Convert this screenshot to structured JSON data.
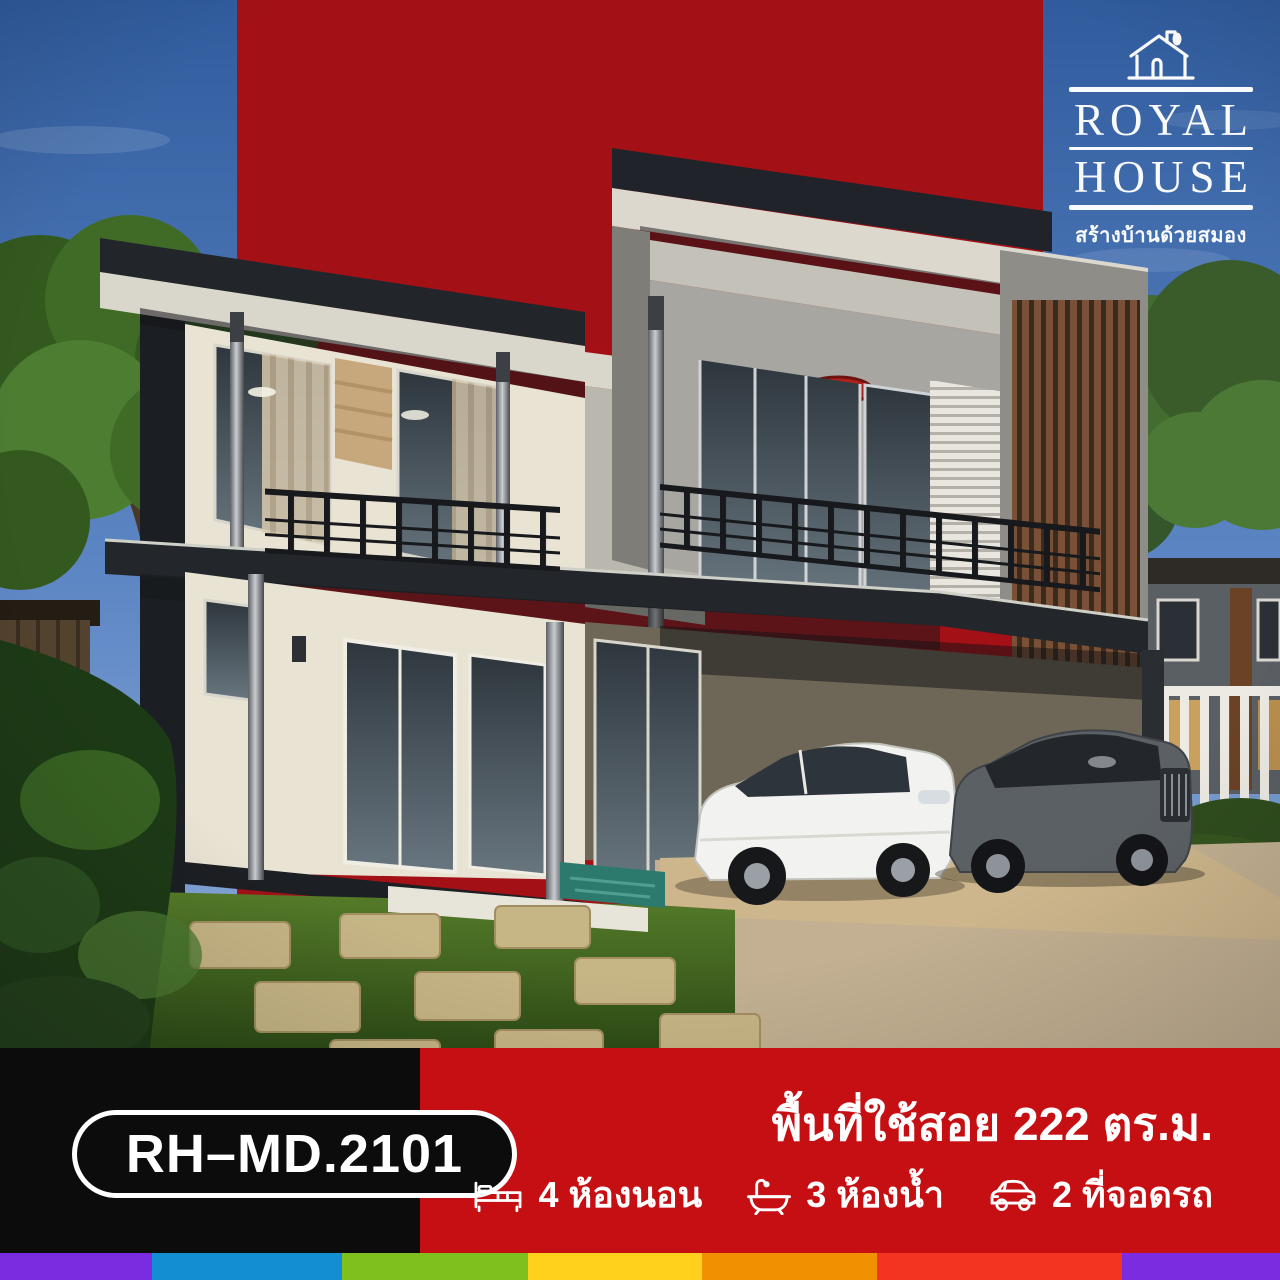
{
  "brand": {
    "name_line1": "ROYAL",
    "name_line2": "HOUSE",
    "tagline": "สร้างบ้านด้วยสมอง"
  },
  "model": {
    "code": "RH–MD.2101"
  },
  "specs": {
    "area_heading": "พื้นที่ใช้สอย 222 ตร.ม.",
    "features": [
      {
        "icon": "bed-icon",
        "label": "4 ห้องนอน"
      },
      {
        "icon": "bath-icon",
        "label": "3 ห้องน้ำ"
      },
      {
        "icon": "car-icon",
        "label": "2 ที่จอดรถ"
      }
    ]
  },
  "colors": {
    "backdrop_red": "#a31116",
    "band_red": "#c60f13",
    "band_black": "#0c0c0c",
    "footer_strip": [
      "#7b2be0",
      "#128fd2",
      "#80c01e",
      "#ffd11d",
      "#f19000",
      "#f33420",
      "#7b2be0"
    ]
  },
  "footer_strip_widths": [
    152,
    190,
    186,
    174,
    175,
    245,
    158
  ]
}
